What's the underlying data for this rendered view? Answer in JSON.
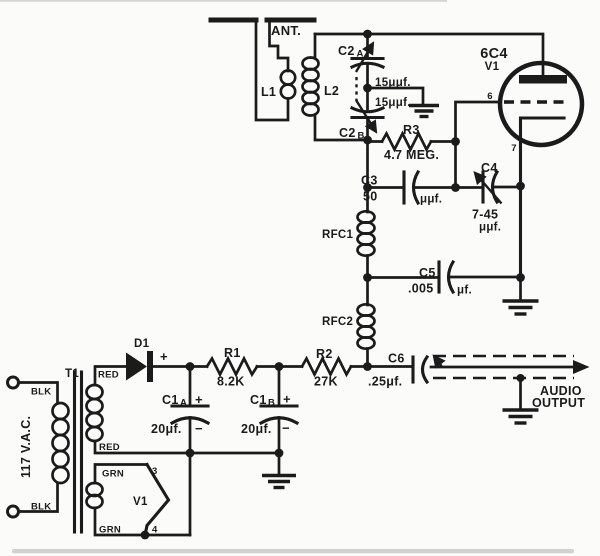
{
  "meta": {
    "background": "#fbfbf9",
    "ink": "#1b1b1b"
  },
  "schematic": {
    "antenna": {
      "label": "ANT."
    },
    "coils": {
      "l1": "L1",
      "l2": "L2",
      "rfc1": "RFC1",
      "rfc2": "RFC2"
    },
    "tuning_cap": {
      "a_base": "C2",
      "a_sub": "A",
      "a_value": "15μμf.",
      "b_base": "C2",
      "b_sub": "B",
      "b_value": "15μμf."
    },
    "tube": {
      "type": "6C4",
      "ref": "V1",
      "grid_pin": "6",
      "cathode_pin": "7"
    },
    "resistors": {
      "r1": "R1",
      "r1_value": "8.2K",
      "r2": "R2",
      "r2_value": "27K",
      "r3": "R3",
      "r3_value": "4.7 MEG."
    },
    "caps": {
      "c3": "C3",
      "c3_value": "50",
      "c3_unit": "μμf.",
      "c4": "C4",
      "c4_value": "7-45",
      "c4_unit": "μμf.",
      "c5": "C5",
      "c5_value": ".005",
      "c5_unit": "μf.",
      "c6": "C6",
      "c6_value": ".25μf."
    },
    "diode": {
      "label": "D1",
      "plus": "+"
    },
    "filters": {
      "a_base": "C1",
      "a_sub": "A",
      "a_value": "20μf.",
      "b_base": "C1",
      "b_sub": "B",
      "b_value": "20μf.",
      "plus": "+",
      "minus": "−"
    },
    "transformer": {
      "label": "T1",
      "input": "117 V.A.C.",
      "blk": "BLK",
      "red": "RED",
      "grn": "GRN"
    },
    "heater": {
      "ref": "V1",
      "pin3": "3",
      "pin4": "4"
    },
    "output": {
      "line1": "AUDIO",
      "line2": "OUTPUT"
    }
  }
}
